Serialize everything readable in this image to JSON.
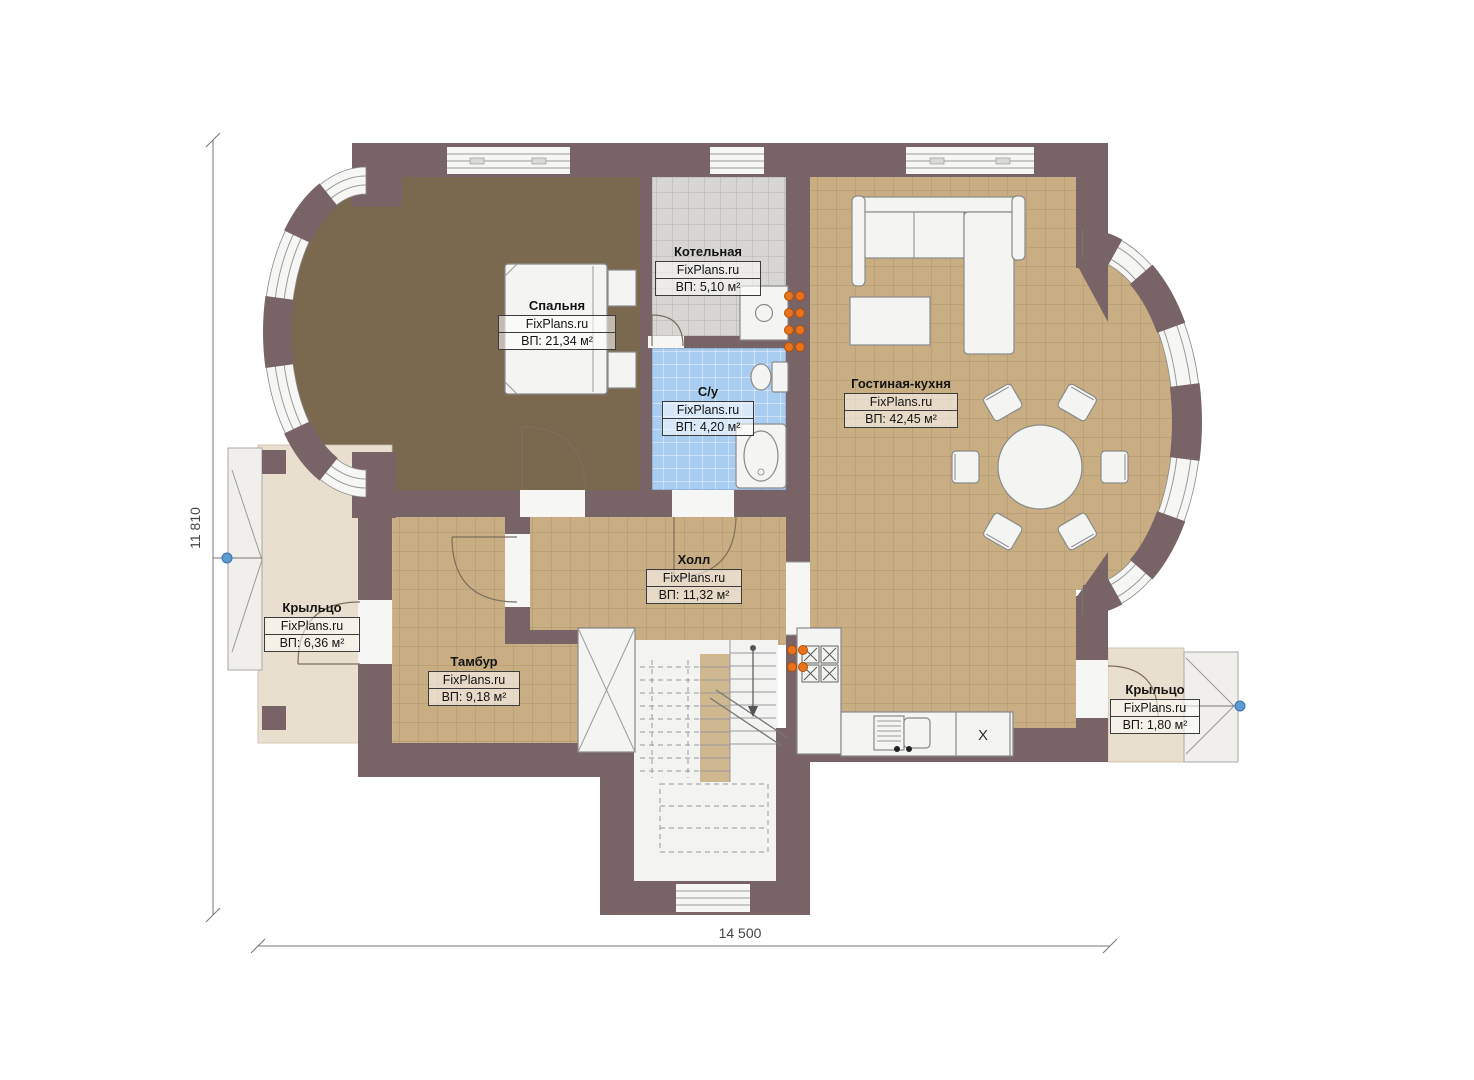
{
  "plan": {
    "brand": "FixPlans.ru",
    "type": "first-floor plan"
  },
  "dimensions": {
    "height_label": "11 810",
    "width_label": "14 500"
  },
  "rooms": [
    {
      "id": "bedroom",
      "name": "Спальня",
      "brand": "FixPlans.ru",
      "area": "ВП: 21,34 м²"
    },
    {
      "id": "boiler",
      "name": "Котельная",
      "brand": "FixPlans.ru",
      "area": "ВП: 5,10 м²"
    },
    {
      "id": "bathroom",
      "name": "С/у",
      "brand": "FixPlans.ru",
      "area": "ВП: 4,20 м²"
    },
    {
      "id": "living-kitchen",
      "name": "Гостиная-кухня",
      "brand": "FixPlans.ru",
      "area": "ВП: 42,45 м²"
    },
    {
      "id": "hall",
      "name": "Холл",
      "brand": "FixPlans.ru",
      "area": "ВП: 11,32 м²"
    },
    {
      "id": "vestibule",
      "name": "Тамбур",
      "brand": "FixPlans.ru",
      "area": "ВП: 9,18 м²"
    },
    {
      "id": "porch-left",
      "name": "Крыльцо",
      "brand": "FixPlans.ru",
      "area": "ВП: 6,36 м²"
    },
    {
      "id": "porch-right",
      "name": "Крыльцо",
      "brand": "FixPlans.ru",
      "area": "ВП: 1,80 м²"
    }
  ],
  "annotations": {
    "kitchen_unit_mark": "X"
  },
  "colors": {
    "wall": "#786467",
    "floor_tan": "#c9ae83",
    "floor_tan_line": "#8d7452",
    "floor_bedroom": "#7a694f",
    "floor_gray": "#d7d6d3",
    "floor_gray_line": "#b3b2ae",
    "floor_blue": "#a9cdf1",
    "porch": "#e9dfce",
    "stair_bg": "#f3f3f1",
    "furniture_fill": "#f4f4f2",
    "furniture_stroke": "#8a8a8a",
    "radiator": "#e8731c",
    "marker_blue": "#5d9bd3",
    "dimension": "#777777"
  }
}
